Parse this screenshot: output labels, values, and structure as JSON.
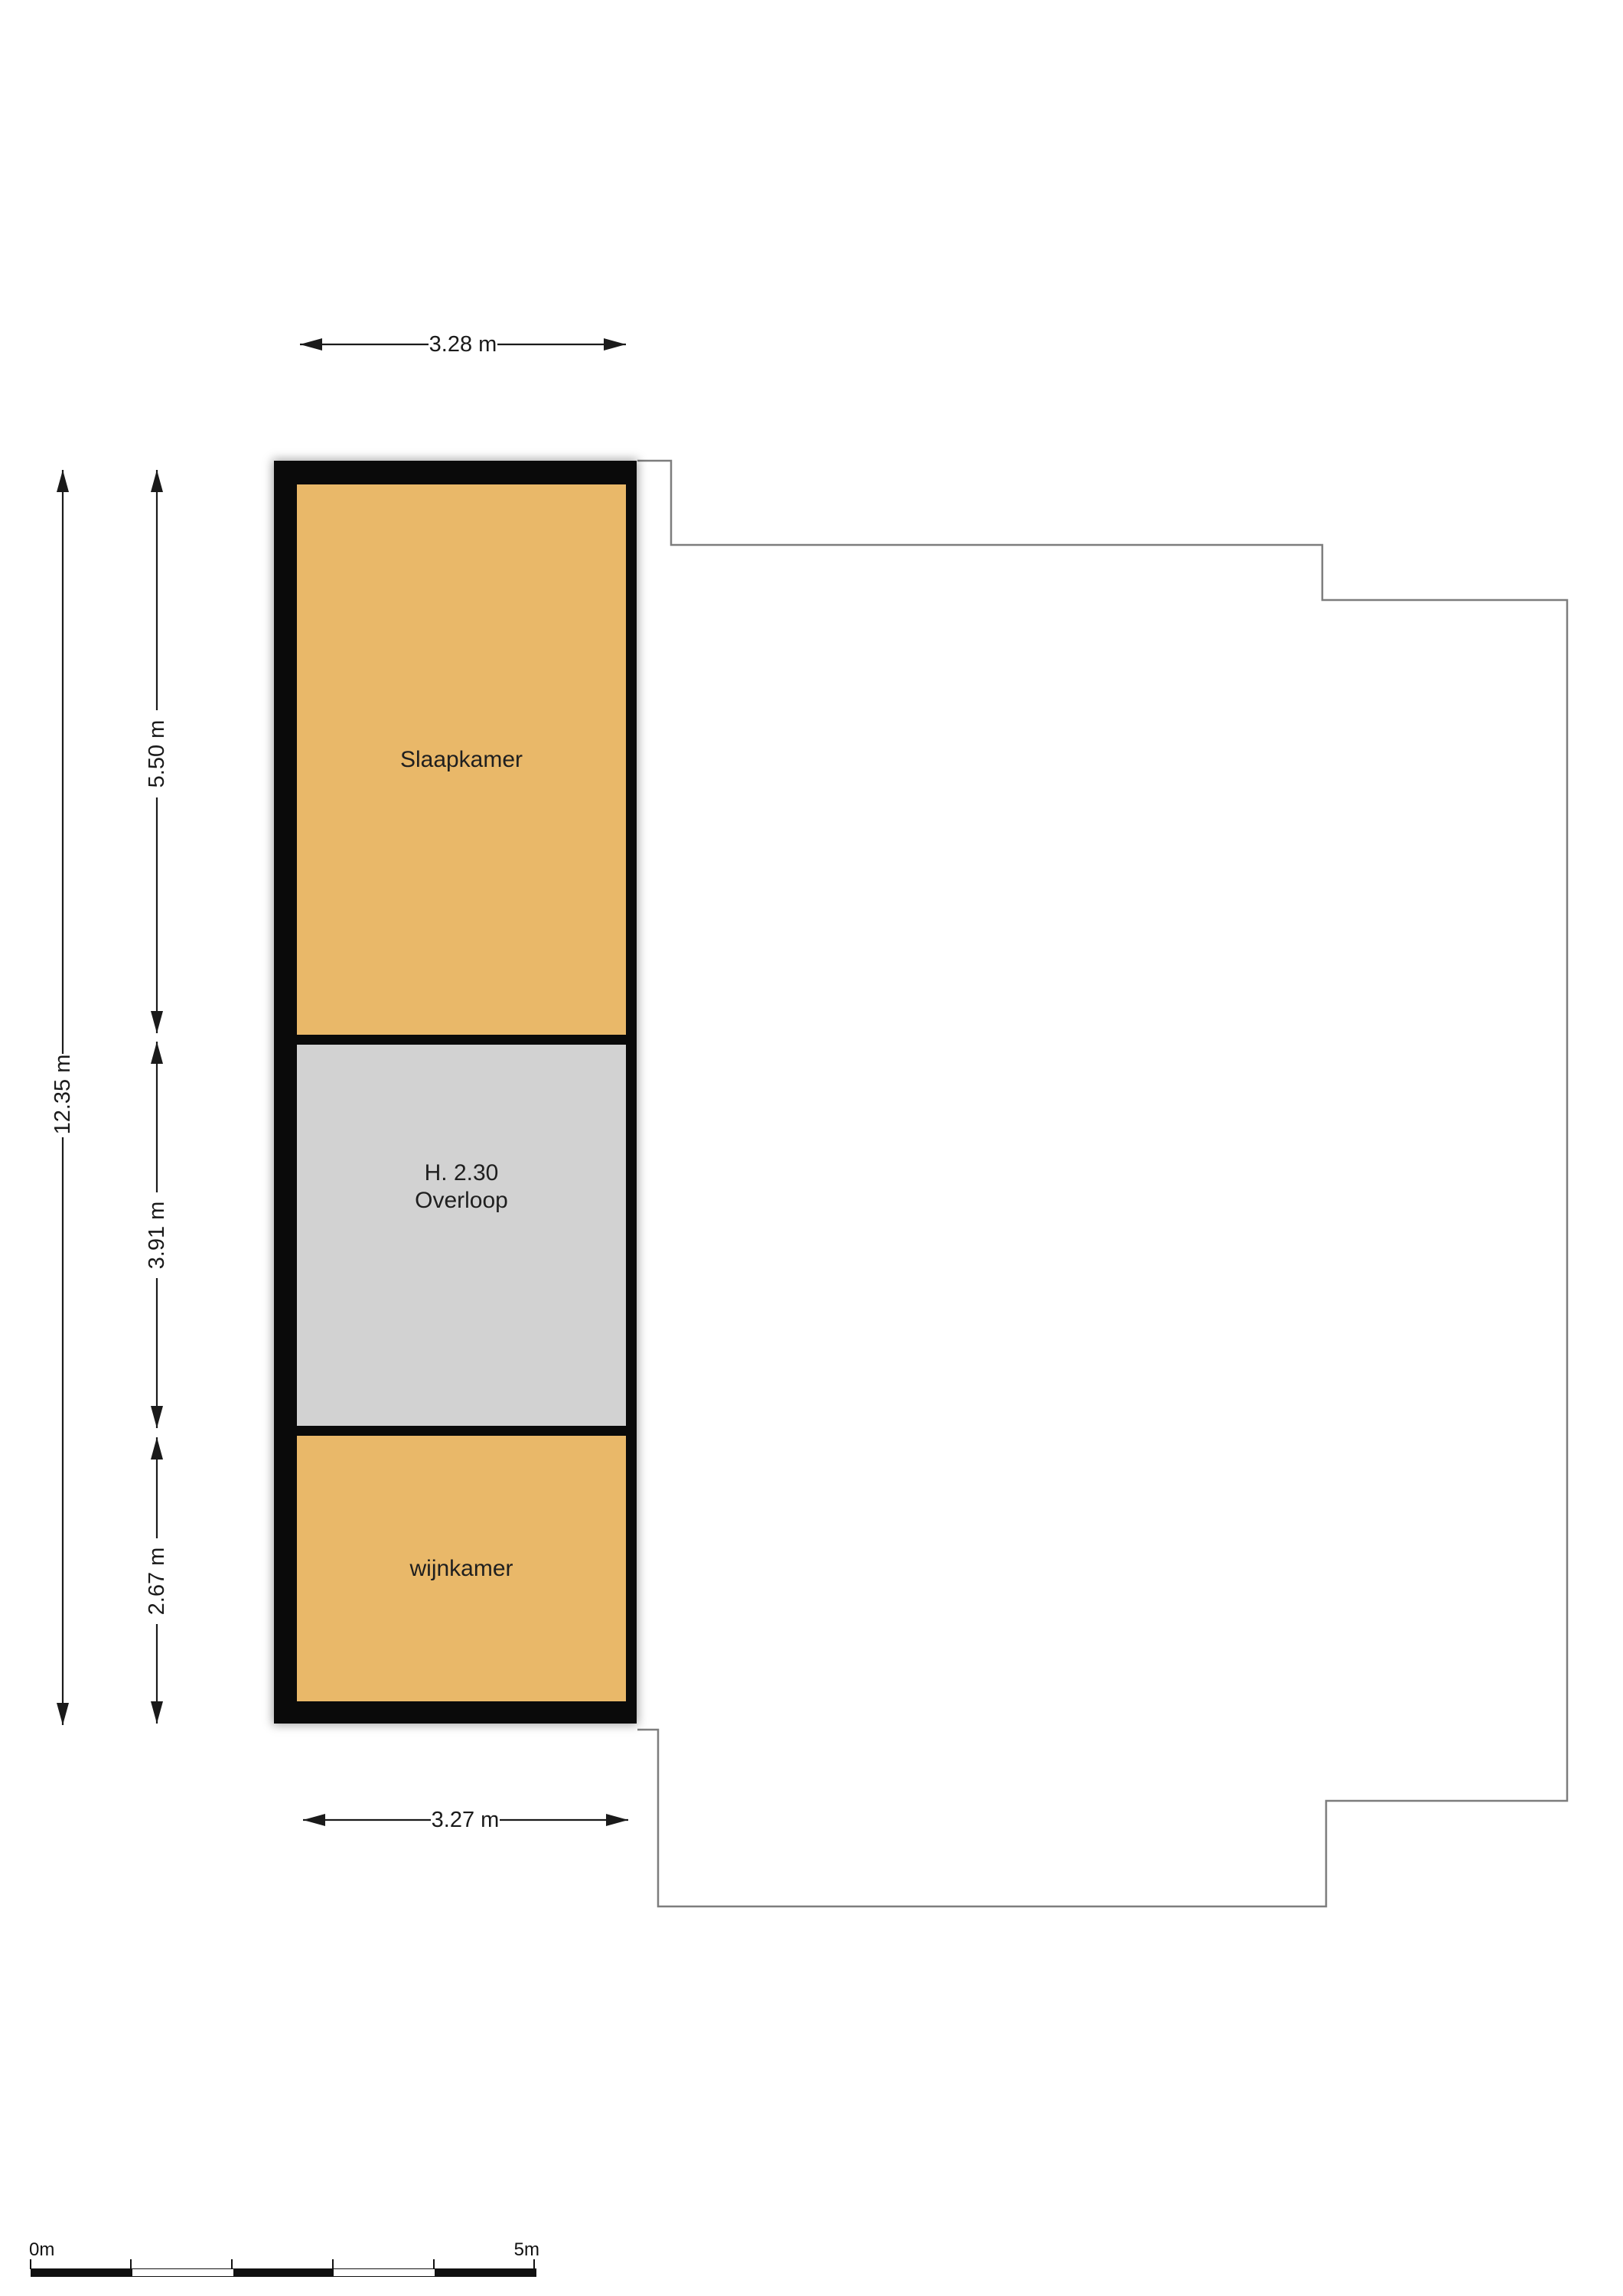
{
  "floorplan": {
    "rooms": [
      {
        "label": "Slaapkamer",
        "color": "#e9b869"
      },
      {
        "height_label": "H. 2.30",
        "label": "Overloop",
        "color": "#d2d2d2"
      },
      {
        "label": "wijnkamer",
        "color": "#e9b869"
      }
    ],
    "wall_color": "#0a0a0a",
    "outline_color": "#7d7d7d",
    "stairs_color": "#c9c9c9",
    "dimensions": {
      "top": "3.28 m",
      "bottom": "3.27 m",
      "left_total": "12.35 m",
      "left_segments": [
        "5.50 m",
        "3.91 m",
        "2.67 m"
      ]
    },
    "scale_bar": {
      "start_label": "0m",
      "end_label": "5m"
    }
  }
}
